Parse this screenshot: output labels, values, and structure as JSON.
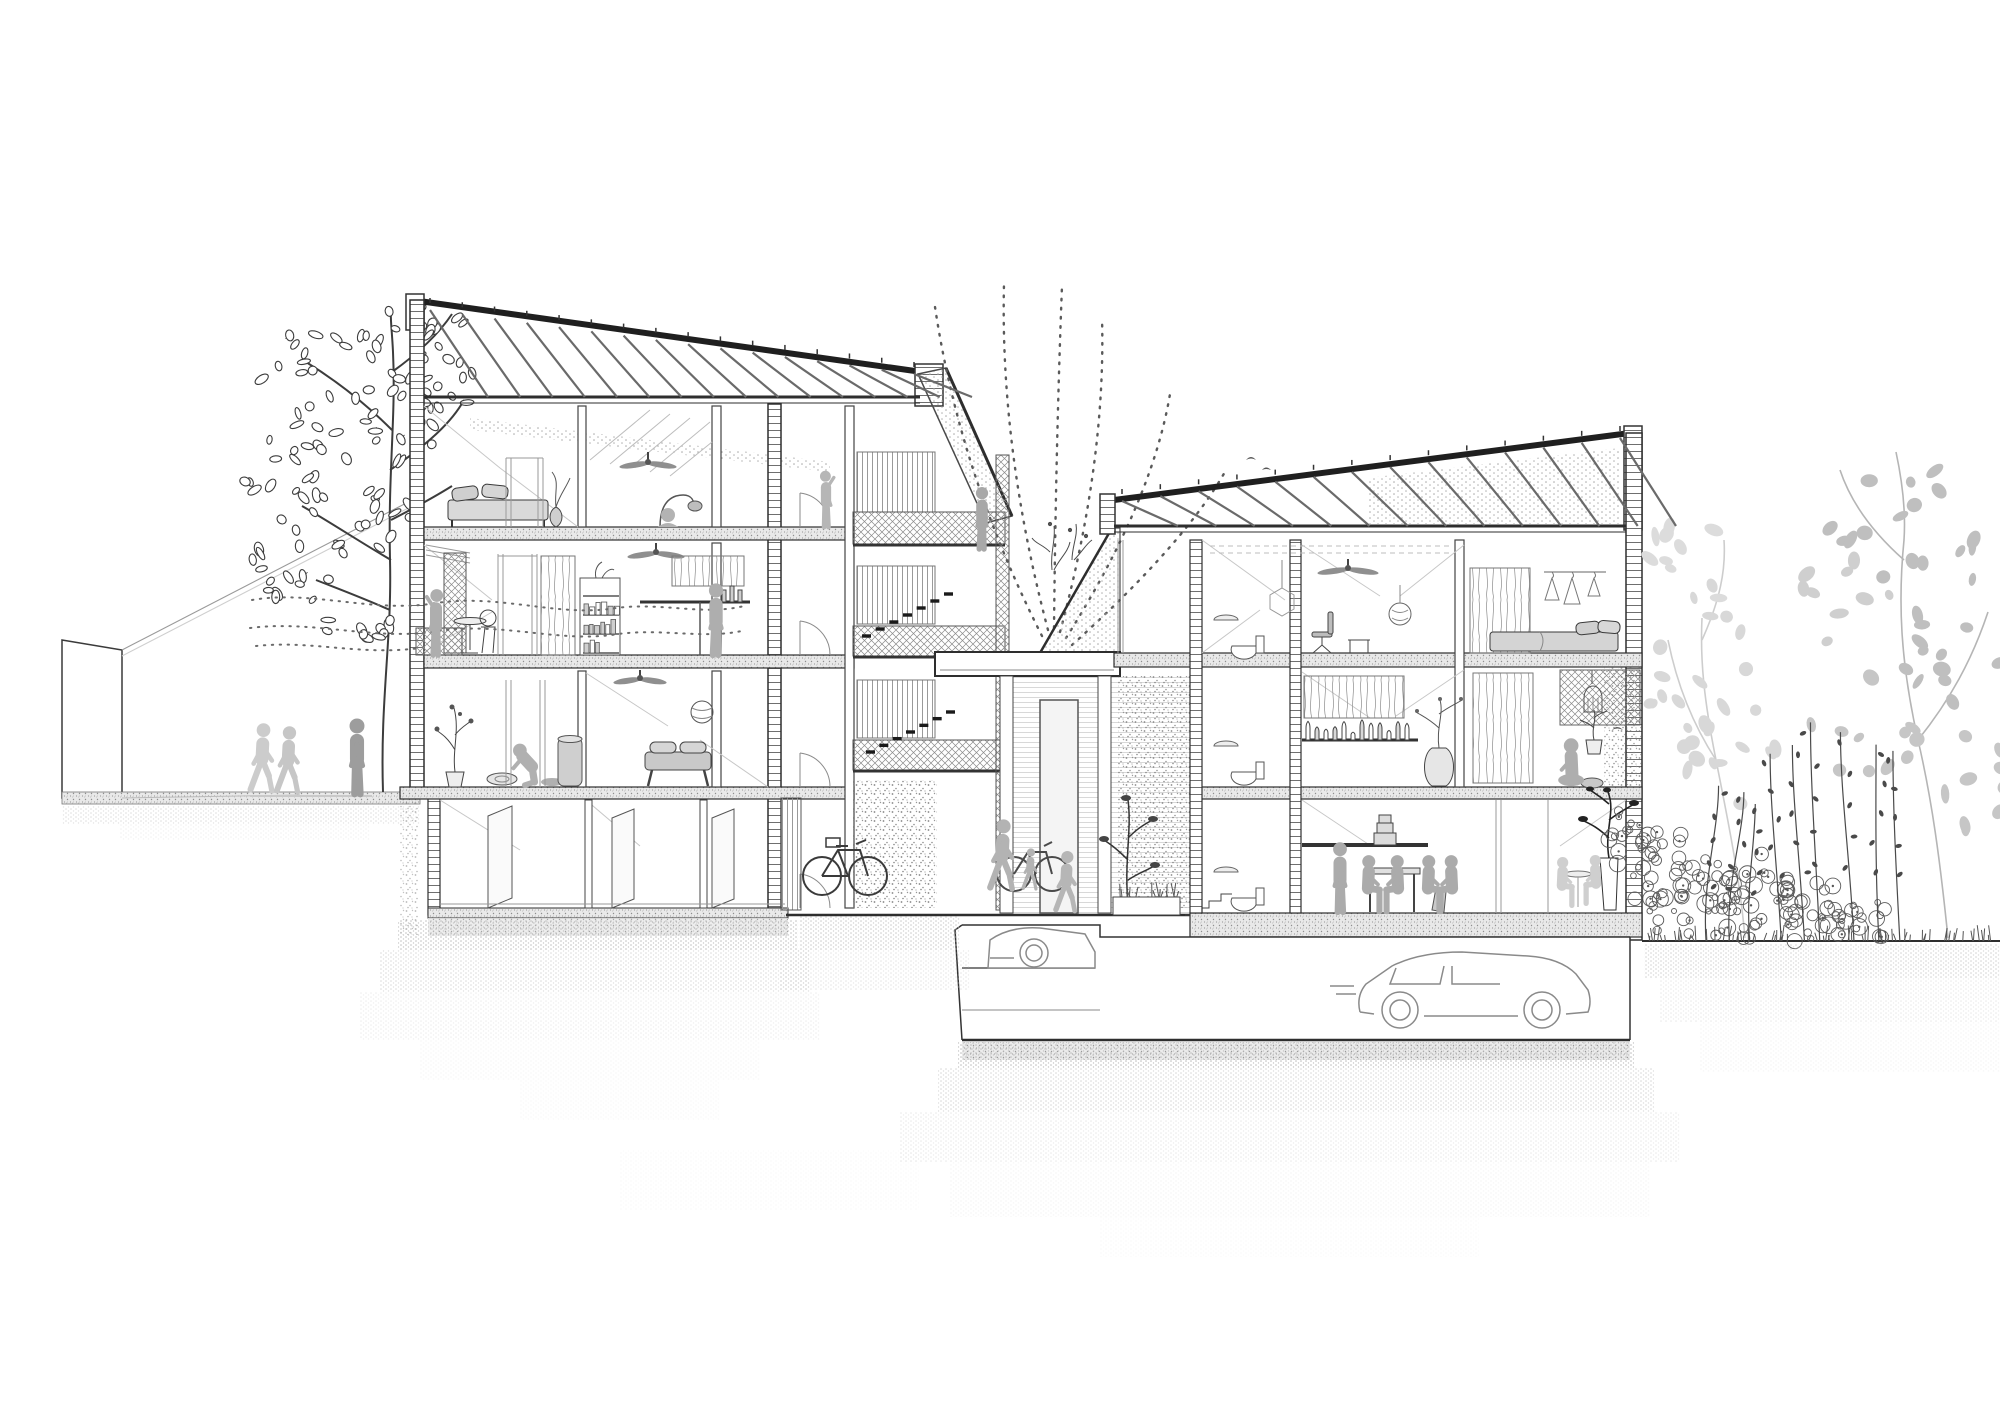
{
  "meta": {
    "kind": "architectural cross-section drawing",
    "subject": "co-housing block: two mono-pitch roofed buildings around a planted courtyard with underground parking",
    "style": "black and white line drawing with gray silhouette figures",
    "canvas": {
      "width": 2000,
      "height": 1414
    }
  },
  "palette": {
    "ink": "#2e2e2e",
    "ink_soft": "#7d7d7d",
    "figure_gray": "#b0b0b0",
    "figure_gray_light": "#cccccc",
    "furniture_gray": "#d6d6d6",
    "tree_light": "#d2d2d2",
    "tree_mid": "#bcbcbc",
    "hatch_gray": "#909090",
    "shadow_dot": "#b8b8b8"
  },
  "inventory": {
    "left_neighbour_wall": "blank party wall at street",
    "street_people_count": 3,
    "left_tree": "deciduous tree with oval leaves at street",
    "left_building_levels": [
      "attic under sloped rafter roof",
      "bedroom floor",
      "living floor with balcony",
      "ground floor living",
      "basement storage"
    ],
    "left_building_rafters": 15,
    "right_building_levels": [
      "attic under sloped rafter roof",
      "studio + bedroom floor",
      "living floor with loggia",
      "ground floor kitchen-dining"
    ],
    "right_building_rafters": 13,
    "courtyard": "planted court with access gallery, bridge canopy, green walls, stair dashes and dotted growth arcs",
    "garage_cars": 2,
    "bicycles": 2,
    "ceiling_fans": 4,
    "people_total": 17,
    "right_garden": "wild shrubs, flower stalks and light gray trees"
  },
  "art": {
    "rafters": [
      {
        "x1": 430,
        "y1": 307,
        "x2": 914,
        "y2": 371,
        "ceil": 397,
        "n": 15,
        "reach": 58
      },
      {
        "x1": 1122,
        "y1": 498,
        "x2": 1620,
        "y2": 435,
        "ceil": 526,
        "n": 13,
        "reach": 56
      }
    ],
    "arcs": [
      "M1042,636 Q958,470 934,300",
      "M1048,630 Q1000,448 1004,284",
      "M1054,628 Q1056,440 1062,286",
      "M1060,632 Q1106,462 1102,318",
      "M1066,638 Q1152,502 1170,394",
      "M1072,645 Q1186,542 1226,470"
    ],
    "airflow": [
      "M252,600 C310,590 368,612 430,604 C498,592 556,618 616,608 C662,602 704,616 744,606",
      "M250,628 C312,620 370,640 432,632 C500,620 558,644 618,634 C664,628 706,640 746,630",
      "M256,646 C312,640 360,656 420,648"
    ],
    "sight_lines": [
      [
        "122,650",
        "418,497"
      ],
      [
        "122,656",
        "418,503"
      ]
    ],
    "leaf_clusters_dark": [
      {
        "cx": 330,
        "cy": 380,
        "rx": 70,
        "ry": 55,
        "n": 26
      },
      {
        "cx": 420,
        "cy": 340,
        "rx": 55,
        "ry": 40,
        "n": 18
      },
      {
        "cx": 300,
        "cy": 470,
        "rx": 60,
        "ry": 45,
        "n": 20
      },
      {
        "cx": 395,
        "cy": 430,
        "rx": 45,
        "ry": 40,
        "n": 14
      },
      {
        "cx": 300,
        "cy": 560,
        "rx": 55,
        "ry": 45,
        "n": 18
      },
      {
        "cx": 380,
        "cy": 520,
        "rx": 40,
        "ry": 35,
        "n": 12
      },
      {
        "cx": 345,
        "cy": 620,
        "rx": 45,
        "ry": 30,
        "n": 12
      },
      {
        "cx": 450,
        "cy": 390,
        "rx": 30,
        "ry": 30,
        "n": 8
      }
    ],
    "leaf_clusters_light": [
      {
        "cx": 1700,
        "cy": 660,
        "rx": 60,
        "ry": 90,
        "n": 16,
        "fill": "#d8d8d8"
      },
      {
        "cx": 1735,
        "cy": 760,
        "rx": 55,
        "ry": 60,
        "n": 12,
        "fill": "#d8d8d8"
      },
      {
        "cx": 1690,
        "cy": 560,
        "rx": 45,
        "ry": 50,
        "n": 9,
        "fill": "#dcdcdc"
      },
      {
        "cx": 1900,
        "cy": 520,
        "rx": 80,
        "ry": 70,
        "n": 16,
        "fill": "#bfbfbf"
      },
      {
        "cx": 1950,
        "cy": 640,
        "rx": 70,
        "ry": 70,
        "n": 14,
        "fill": "#bfbfbf"
      },
      {
        "cx": 1870,
        "cy": 720,
        "rx": 60,
        "ry": 60,
        "n": 11,
        "fill": "#c6c6c6"
      },
      {
        "cx": 1960,
        "cy": 780,
        "rx": 55,
        "ry": 50,
        "n": 9,
        "fill": "#c6c6c6"
      },
      {
        "cx": 1845,
        "cy": 600,
        "rx": 45,
        "ry": 55,
        "n": 9,
        "fill": "#cfcfcf"
      }
    ],
    "bushes": [
      {
        "cx": 1665,
        "cy": 880,
        "rx": 35,
        "ry": 55,
        "n": 30
      },
      {
        "cx": 1705,
        "cy": 900,
        "rx": 38,
        "ry": 45,
        "n": 30
      },
      {
        "cx": 1755,
        "cy": 895,
        "rx": 40,
        "ry": 50,
        "n": 32
      },
      {
        "cx": 1810,
        "cy": 910,
        "rx": 35,
        "ry": 35,
        "n": 24
      },
      {
        "cx": 1860,
        "cy": 920,
        "rx": 30,
        "ry": 26,
        "n": 18
      },
      {
        "cx": 1630,
        "cy": 845,
        "rx": 22,
        "ry": 40,
        "n": 18
      }
    ],
    "stalks": {
      "x1": 1700,
      "x2": 1900,
      "ground": 941,
      "n": 9
    },
    "grass_bands": [
      {
        "x1": 1646,
        "x2": 1995,
        "y": 941,
        "n": 70
      },
      {
        "x1": 1115,
        "x2": 1178,
        "y": 897,
        "n": 16
      }
    ],
    "figures": [
      {
        "pose": "walk",
        "x": 262,
        "y": 791,
        "h": 70,
        "fill": "#cccccc",
        "flip": 1
      },
      {
        "pose": "walk",
        "x": 288,
        "y": 792,
        "h": 68,
        "fill": "#c6c6c6",
        "flip": 1
      },
      {
        "pose": "stand",
        "x": 357,
        "y": 794,
        "h": 78,
        "fill": "#9d9d9d",
        "flip": 1
      },
      {
        "pose": "reach",
        "x": 436,
        "y": 655,
        "h": 68,
        "fill": "#aeaeae",
        "flip": -1
      },
      {
        "pose": "reach",
        "x": 826,
        "y": 527,
        "h": 58,
        "fill": "#b6b6b6",
        "flip": 1
      },
      {
        "pose": "stand",
        "x": 716,
        "y": 655,
        "h": 74,
        "fill": "#aeaeae",
        "flip": -1
      },
      {
        "pose": "crouch",
        "x": 532,
        "y": 786,
        "h": 42,
        "fill": "#b0b0b0",
        "flip": -1
      },
      {
        "pose": "stand",
        "x": 982,
        "y": 549,
        "h": 64,
        "fill": "#a8a8a8",
        "flip": -1
      },
      {
        "pose": "walk",
        "x": 1066,
        "y": 911,
        "h": 62,
        "fill": "#b6b6b6",
        "flip": 1
      },
      {
        "pose": "walk",
        "x": 1002,
        "y": 889,
        "h": 72,
        "fill": "#b3b3b3",
        "flip": 1
      },
      {
        "pose": "walk",
        "x": 1030,
        "y": 889,
        "h": 42,
        "fill": "#b3b3b3",
        "flip": 1
      },
      {
        "pose": "stand",
        "x": 1340,
        "y": 912,
        "h": 72,
        "fill": "#ababab",
        "flip": 1
      },
      {
        "pose": "sitchair",
        "x": 1368,
        "y": 912,
        "h": 58,
        "fill": "#ababab",
        "flip": 1
      },
      {
        "pose": "sitchair",
        "x": 1398,
        "y": 912,
        "h": 58,
        "fill": "#ababab",
        "flip": -1
      },
      {
        "pose": "sitchair",
        "x": 1428,
        "y": 912,
        "h": 58,
        "fill": "#ababab",
        "flip": 1
      },
      {
        "pose": "sitchair",
        "x": 1452,
        "y": 912,
        "h": 58,
        "fill": "#ababab",
        "flip": -1
      },
      {
        "pose": "sitfloor",
        "x": 1572,
        "y": 787,
        "h": 50,
        "fill": "#aeaeae",
        "flip": -1
      },
      {
        "pose": "sitchair",
        "x": 1562,
        "y": 906,
        "h": 50,
        "fill": "#cfcfcf",
        "flip": 1
      },
      {
        "pose": "sitchair",
        "x": 1596,
        "y": 904,
        "h": 50,
        "fill": "#cfcfcf",
        "flip": -1
      }
    ],
    "stair_dashes": [
      {
        "x1": 862,
        "y1": 636,
        "x2": 944,
        "y2": 594,
        "n": 7
      },
      {
        "x1": 866,
        "y1": 752,
        "x2": 946,
        "y2": 712,
        "n": 7
      }
    ],
    "shadow_bands": [
      {
        "x": 398,
        "y": 920,
        "w": 400,
        "h": 30,
        "o": 0.85
      },
      {
        "x": 380,
        "y": 950,
        "w": 430,
        "h": 42,
        "o": 0.5
      },
      {
        "x": 360,
        "y": 992,
        "w": 460,
        "h": 48,
        "o": 0.25
      },
      {
        "x": 420,
        "y": 1040,
        "w": 340,
        "h": 40,
        "o": 0.12
      },
      {
        "x": 800,
        "y": 916,
        "w": 160,
        "h": 34,
        "o": 0.7
      },
      {
        "x": 780,
        "y": 950,
        "w": 190,
        "h": 40,
        "o": 0.35
      },
      {
        "x": 958,
        "y": 1042,
        "w": 676,
        "h": 26,
        "o": 0.9
      },
      {
        "x": 938,
        "y": 1068,
        "w": 716,
        "h": 44,
        "o": 0.55
      },
      {
        "x": 900,
        "y": 1112,
        "w": 780,
        "h": 50,
        "o": 0.3
      },
      {
        "x": 950,
        "y": 1162,
        "w": 700,
        "h": 55,
        "o": 0.15
      },
      {
        "x": 1100,
        "y": 1217,
        "w": 380,
        "h": 40,
        "o": 0.08
      },
      {
        "x": 1644,
        "y": 944,
        "w": 360,
        "h": 34,
        "o": 0.6
      },
      {
        "x": 1660,
        "y": 978,
        "w": 344,
        "h": 44,
        "o": 0.3
      },
      {
        "x": 1700,
        "y": 1022,
        "w": 300,
        "h": 50,
        "o": 0.15
      },
      {
        "x": 62,
        "y": 806,
        "w": 358,
        "h": 18,
        "o": 0.45
      },
      {
        "x": 120,
        "y": 824,
        "w": 250,
        "h": 16,
        "o": 0.2
      },
      {
        "x": 620,
        "y": 1150,
        "w": 300,
        "h": 60,
        "o": 0.08
      },
      {
        "x": 520,
        "y": 1080,
        "w": 200,
        "h": 40,
        "o": 0.1
      }
    ],
    "trunks_dark": [
      "M383,792 C380,700 392,640 390,560 C388,470 396,420 393,352 C392,330 390,318 391,308",
      "M391,560 C360,542 330,522 302,506",
      "M390,470 C428,444 452,422 464,400",
      "M392,430 C362,400 332,378 306,362",
      "M392,372 C420,352 440,332 452,314",
      "M391,520 C420,505 436,496 452,486",
      "M390,610 C358,596 336,588 316,580"
    ],
    "trunks_light": [
      {
        "d": "M1948,938 C1940,860 1932,800 1918,740 C1900,660 1898,600 1904,540 C1906,510 1902,480 1896,452",
        "c": "#b5b5b5"
      },
      {
        "d": "M1918,740 C1950,700 1972,660 1988,612",
        "c": "#b5b5b5"
      },
      {
        "d": "M1904,560 C1870,530 1850,500 1840,470",
        "c": "#b5b5b5"
      },
      {
        "d": "M1745,938 C1740,880 1728,820 1716,760 C1704,700 1700,660 1702,618",
        "c": "#cdcdcd"
      },
      {
        "d": "M1716,760 C1690,720 1676,680 1668,640",
        "c": "#cdcdcd"
      },
      {
        "d": "M1702,640 C1720,600 1726,570 1724,540",
        "c": "#cdcdcd"
      }
    ],
    "books": {
      "shelves": [
        {
          "x": 583,
          "y": 596,
          "w": 36
        },
        {
          "x": 583,
          "y": 615,
          "w": 36
        },
        {
          "x": 583,
          "y": 634,
          "w": 36
        },
        {
          "x": 583,
          "y": 653,
          "w": 36
        }
      ]
    },
    "bottles_shelf": {
      "x": 1306,
      "y": 740,
      "n": 12
    }
  }
}
